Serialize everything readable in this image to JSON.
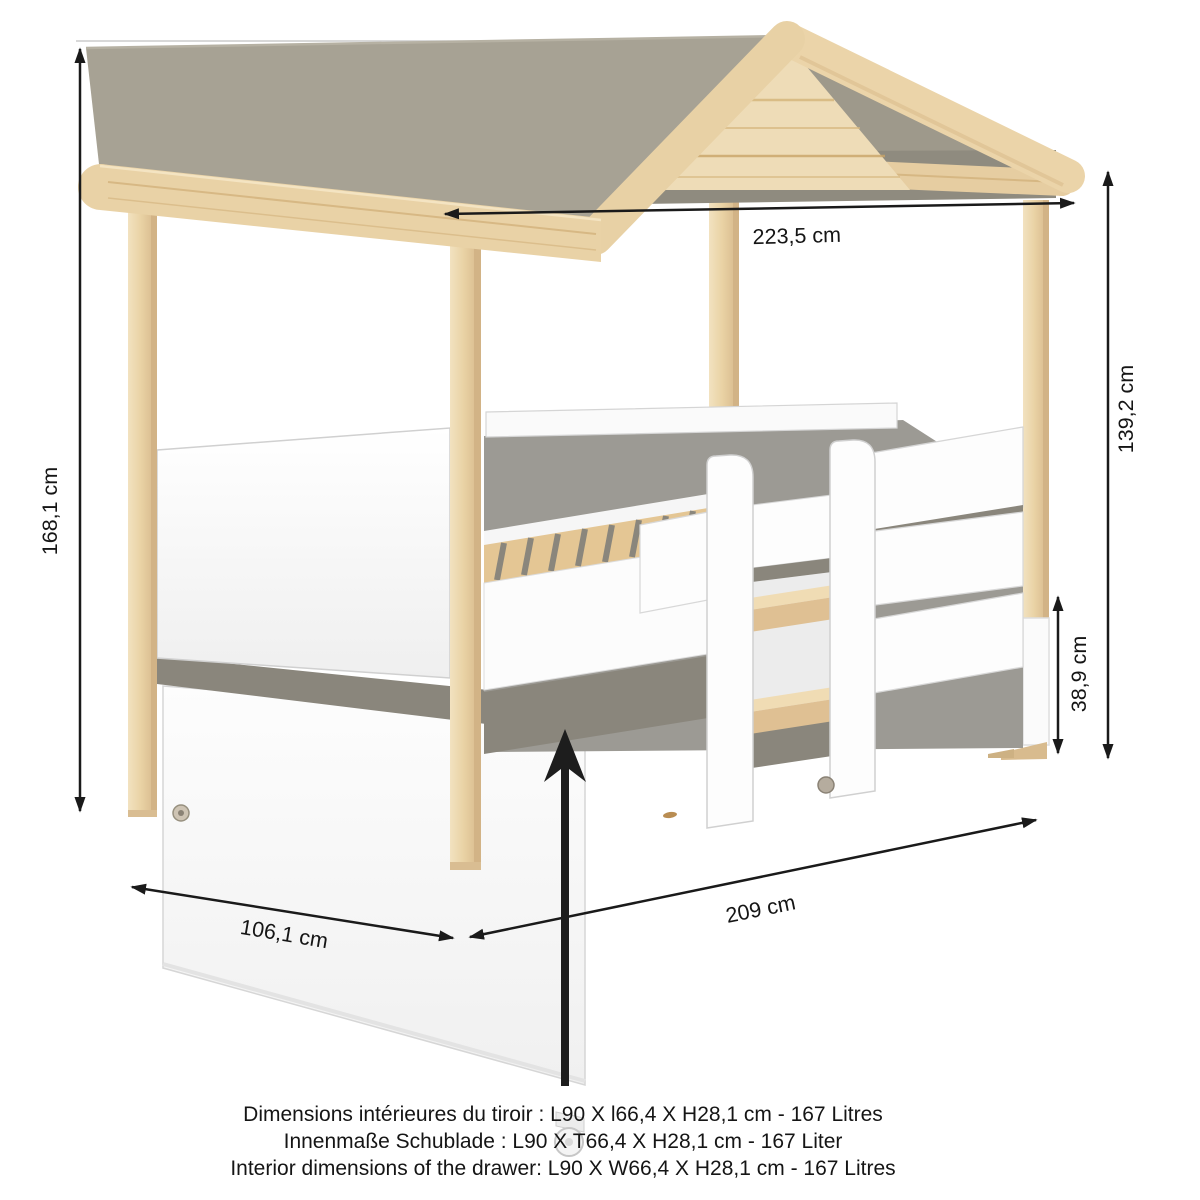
{
  "diagram_type": "product-dimension-diagram",
  "product": "cabin bed with roof canopy, guard rails, ladder and under-bed drawer",
  "dims": {
    "roof_width": "223,5 cm",
    "overall_height": "168,1 cm",
    "canopy_height": "139,2 cm",
    "drawer_height": "38,9 cm",
    "length": "209 cm",
    "depth": "106,1 cm"
  },
  "notes": {
    "fr": "Dimensions intérieures du tiroir : L90 X l66,4 X H28,1 cm  -  167 Litres",
    "de": "Innenmaße Schublade : L90 X T66,4 X H28,1 cm  -  167 Liter",
    "en": "Interior dimensions of the drawer:  L90 X W66,4 X H28,1 cm  -  167 Litres"
  },
  "colors": {
    "roof_gray": "#a7a294",
    "roof_back_gray": "#9e998b",
    "underside_gray": "#8a867c",
    "deck_gray": "#9c9a94",
    "wood_light": "#e9d2a4",
    "panel_white": "#fdfdfd",
    "dimension_line": "#1a1a1a"
  }
}
